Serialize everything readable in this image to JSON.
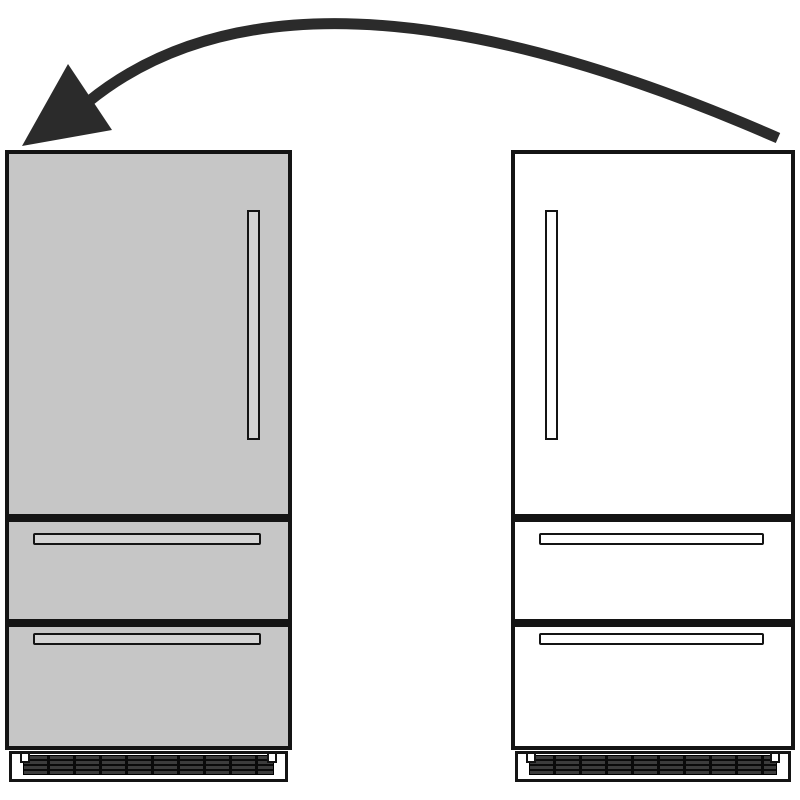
{
  "page": {
    "background": "#ffffff"
  },
  "diagram": {
    "kind": "refrigerator-swap-illustration",
    "outline_color": "#141414",
    "arrow": {
      "icon": "curved-swap-arrow-icon",
      "direction": "right-to-left",
      "color": "#2b2b2b"
    },
    "units": {
      "left": {
        "name": "refrigerator-highlighted",
        "fill": "#c6c6c6",
        "handle_fill": "#d4d4d4",
        "door_handle_side": "right"
      },
      "right": {
        "name": "refrigerator-plain",
        "fill": "#ffffff",
        "handle_fill": "#ffffff",
        "door_handle_side": "left"
      }
    },
    "grille": {
      "frame": "#141414",
      "slat": "#3c3c3c",
      "base": "#0a0a0a"
    }
  }
}
